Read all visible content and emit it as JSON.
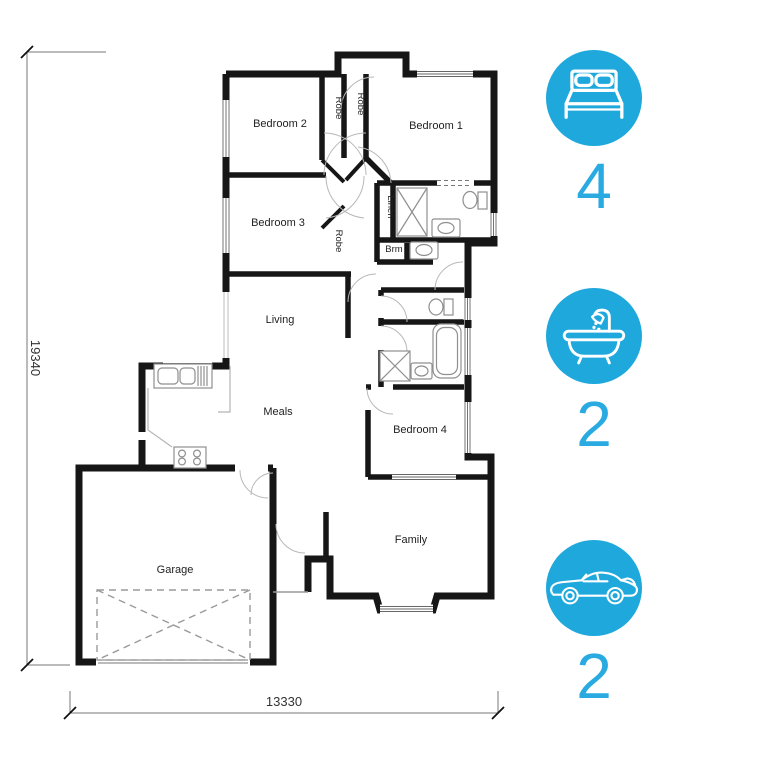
{
  "accent_color": "#29abe2",
  "circle_color": "#1fa8dc",
  "plan": {
    "rooms": {
      "bedroom1": "Bedroom 1",
      "bedroom2": "Bedroom 2",
      "bedroom3": "Bedroom 3",
      "bedroom4": "Bedroom 4",
      "living": "Living",
      "meals": "Meals",
      "family": "Family",
      "garage": "Garage"
    },
    "closets": {
      "robe_bed2": "Robe",
      "robe_hall": "Robe",
      "robe_bed3": "Robe",
      "linen": "Linen",
      "brm": "Brm"
    },
    "dimensions": {
      "overall_depth": "19340",
      "overall_width": "13330"
    }
  },
  "stats": {
    "bedrooms": {
      "icon": "bed-icon",
      "count": "4"
    },
    "bathrooms": {
      "icon": "bath-icon",
      "count": "2"
    },
    "car_spaces": {
      "icon": "car-icon",
      "count": "2"
    }
  }
}
